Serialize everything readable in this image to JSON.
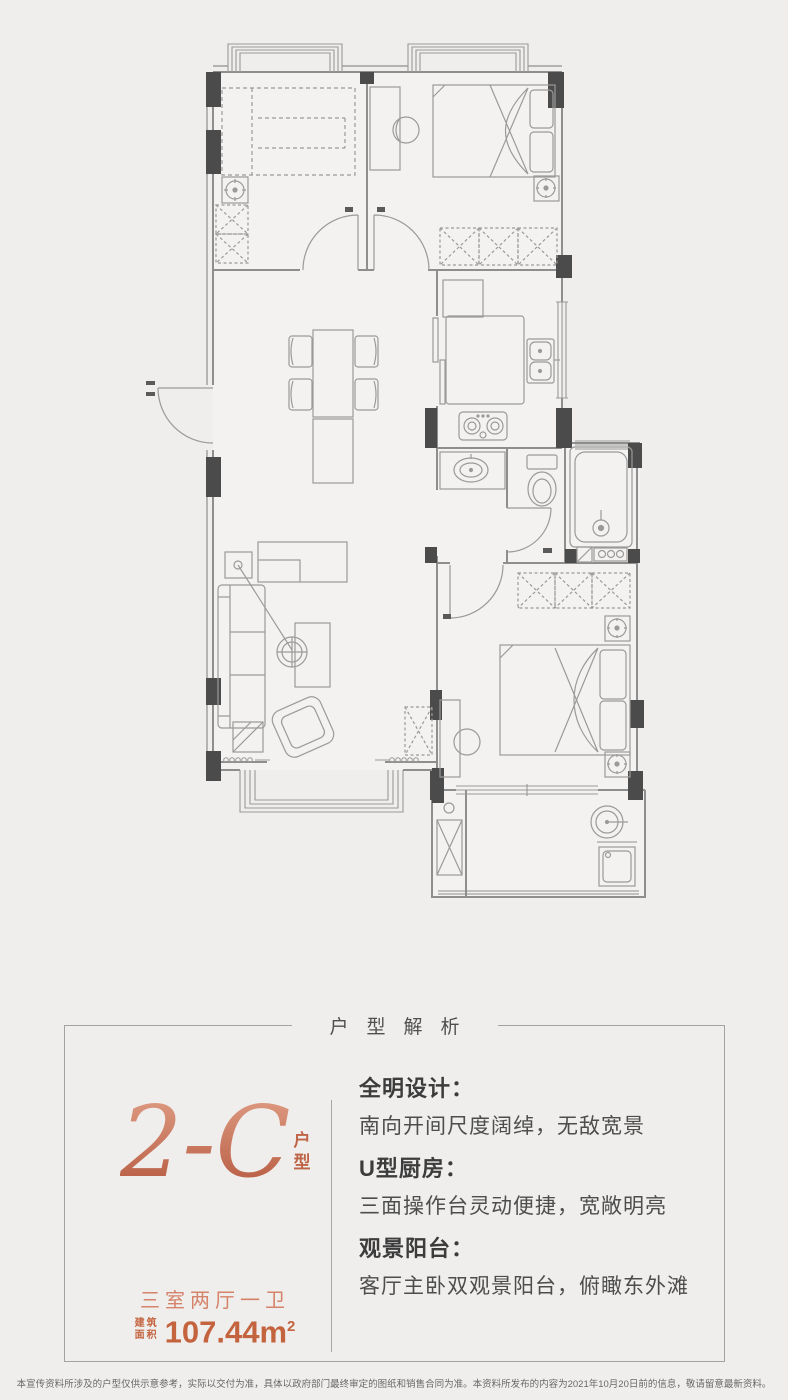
{
  "page": {
    "background": "#efeeec"
  },
  "colors": {
    "wall_line": "#8e8e8e",
    "furniture_line": "#9a9a9a",
    "column_fill": "#4b4b4b",
    "copper": "#c4643f",
    "copper_light": "#d5836a",
    "gradient_top": "#e2a289",
    "gradient_bottom": "#b2543a",
    "text_dark": "#3c3c3c",
    "border": "#a3a3a2"
  },
  "floor_plan": {
    "type": "residential apartment floor plan drawing, no text labels",
    "rooms": [
      "bedroom-top-left",
      "bedroom-top-right",
      "kitchen",
      "wash-area",
      "toilet-room",
      "shower-room",
      "living-dining-room",
      "master-bedroom",
      "living-balcony",
      "master-balcony"
    ],
    "fixtures": [
      "tatami-bed",
      "wardrobes",
      "double-bed",
      "desk-and-chair",
      "dining-table-with-chairs",
      "sofa",
      "coffee-table",
      "floor-lamp",
      "armchair",
      "tv-cabinet",
      "fridge",
      "kitchen-counter",
      "double-sink",
      "gas-stove",
      "wash-basin",
      "toilet",
      "bathtub-with-shower",
      "washing-machine",
      "balcony-basin",
      "ac-units",
      "bay-windows",
      "entry-door"
    ]
  },
  "analysis": {
    "header": "户型解析",
    "unit": {
      "name": "2-C",
      "suffix_char_1": "户",
      "suffix_char_2": "型",
      "spec": "三室两厅一卫",
      "area_label_1": "建筑",
      "area_label_2": "面积",
      "area_value": "107.44m",
      "area_sup": "2"
    },
    "features": [
      {
        "title": "全明设计：",
        "desc": "南向开间尺度阔绰，无敌宽景"
      },
      {
        "title": "U型厨房：",
        "desc": "三面操作台灵动便捷，宽敞明亮"
      },
      {
        "title": "观景阳台：",
        "desc": "客厅主卧双观景阳台，俯瞰东外滩"
      }
    ]
  },
  "disclaimer": "本宣传资料所涉及的户型仅供示意参考，实际以交付为准，具体以政府部门最终审定的图纸和销售合同为准。本资料所发布的内容为2021年10月20日前的信息，敬请留意最新资料。"
}
